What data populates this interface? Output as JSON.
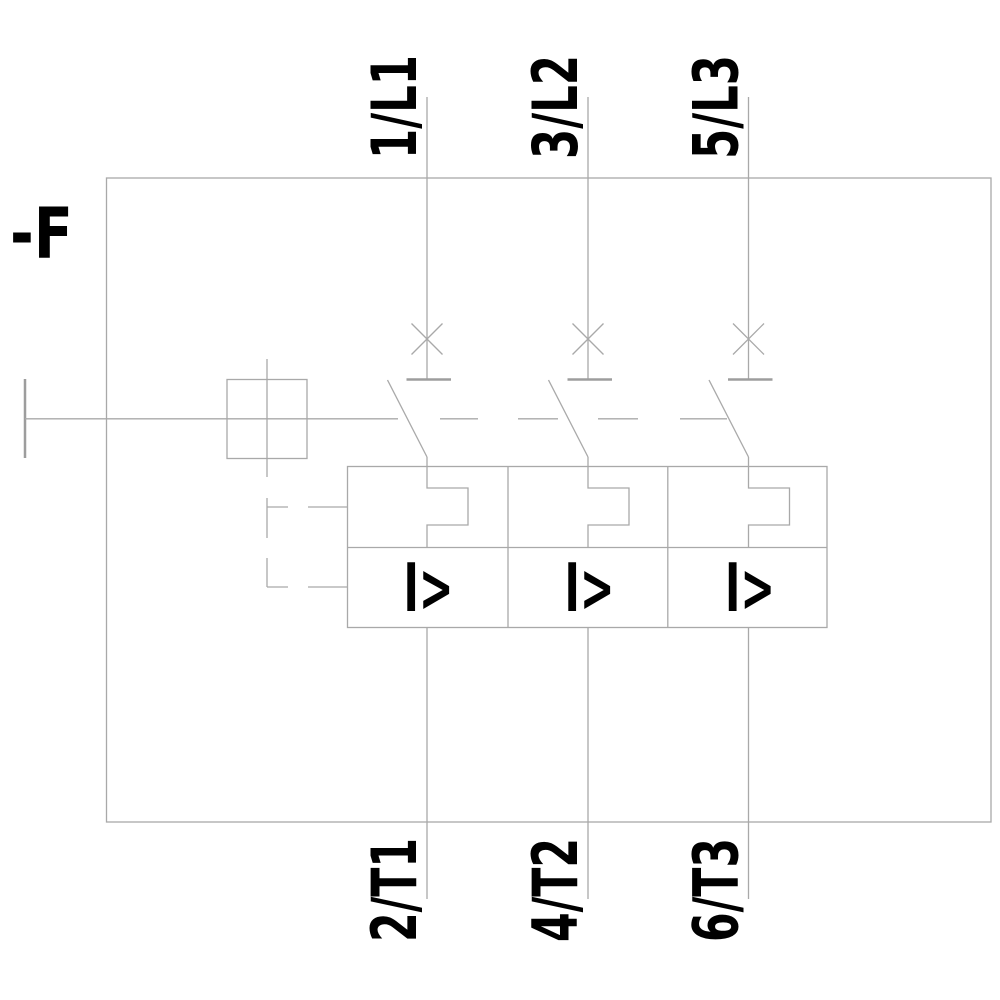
{
  "diagram": {
    "designation": "-F",
    "colors": {
      "line": "#a9a9a9",
      "ink": "#000000",
      "background": "#ffffff"
    },
    "poles": [
      {
        "top_terminal": "1/L1",
        "bottom_terminal": "2/T1",
        "release_label": "I>"
      },
      {
        "top_terminal": "3/L2",
        "bottom_terminal": "4/T2",
        "release_label": "I>"
      },
      {
        "top_terminal": "5/L3",
        "bottom_terminal": "6/T3",
        "release_label": "I>"
      }
    ]
  }
}
